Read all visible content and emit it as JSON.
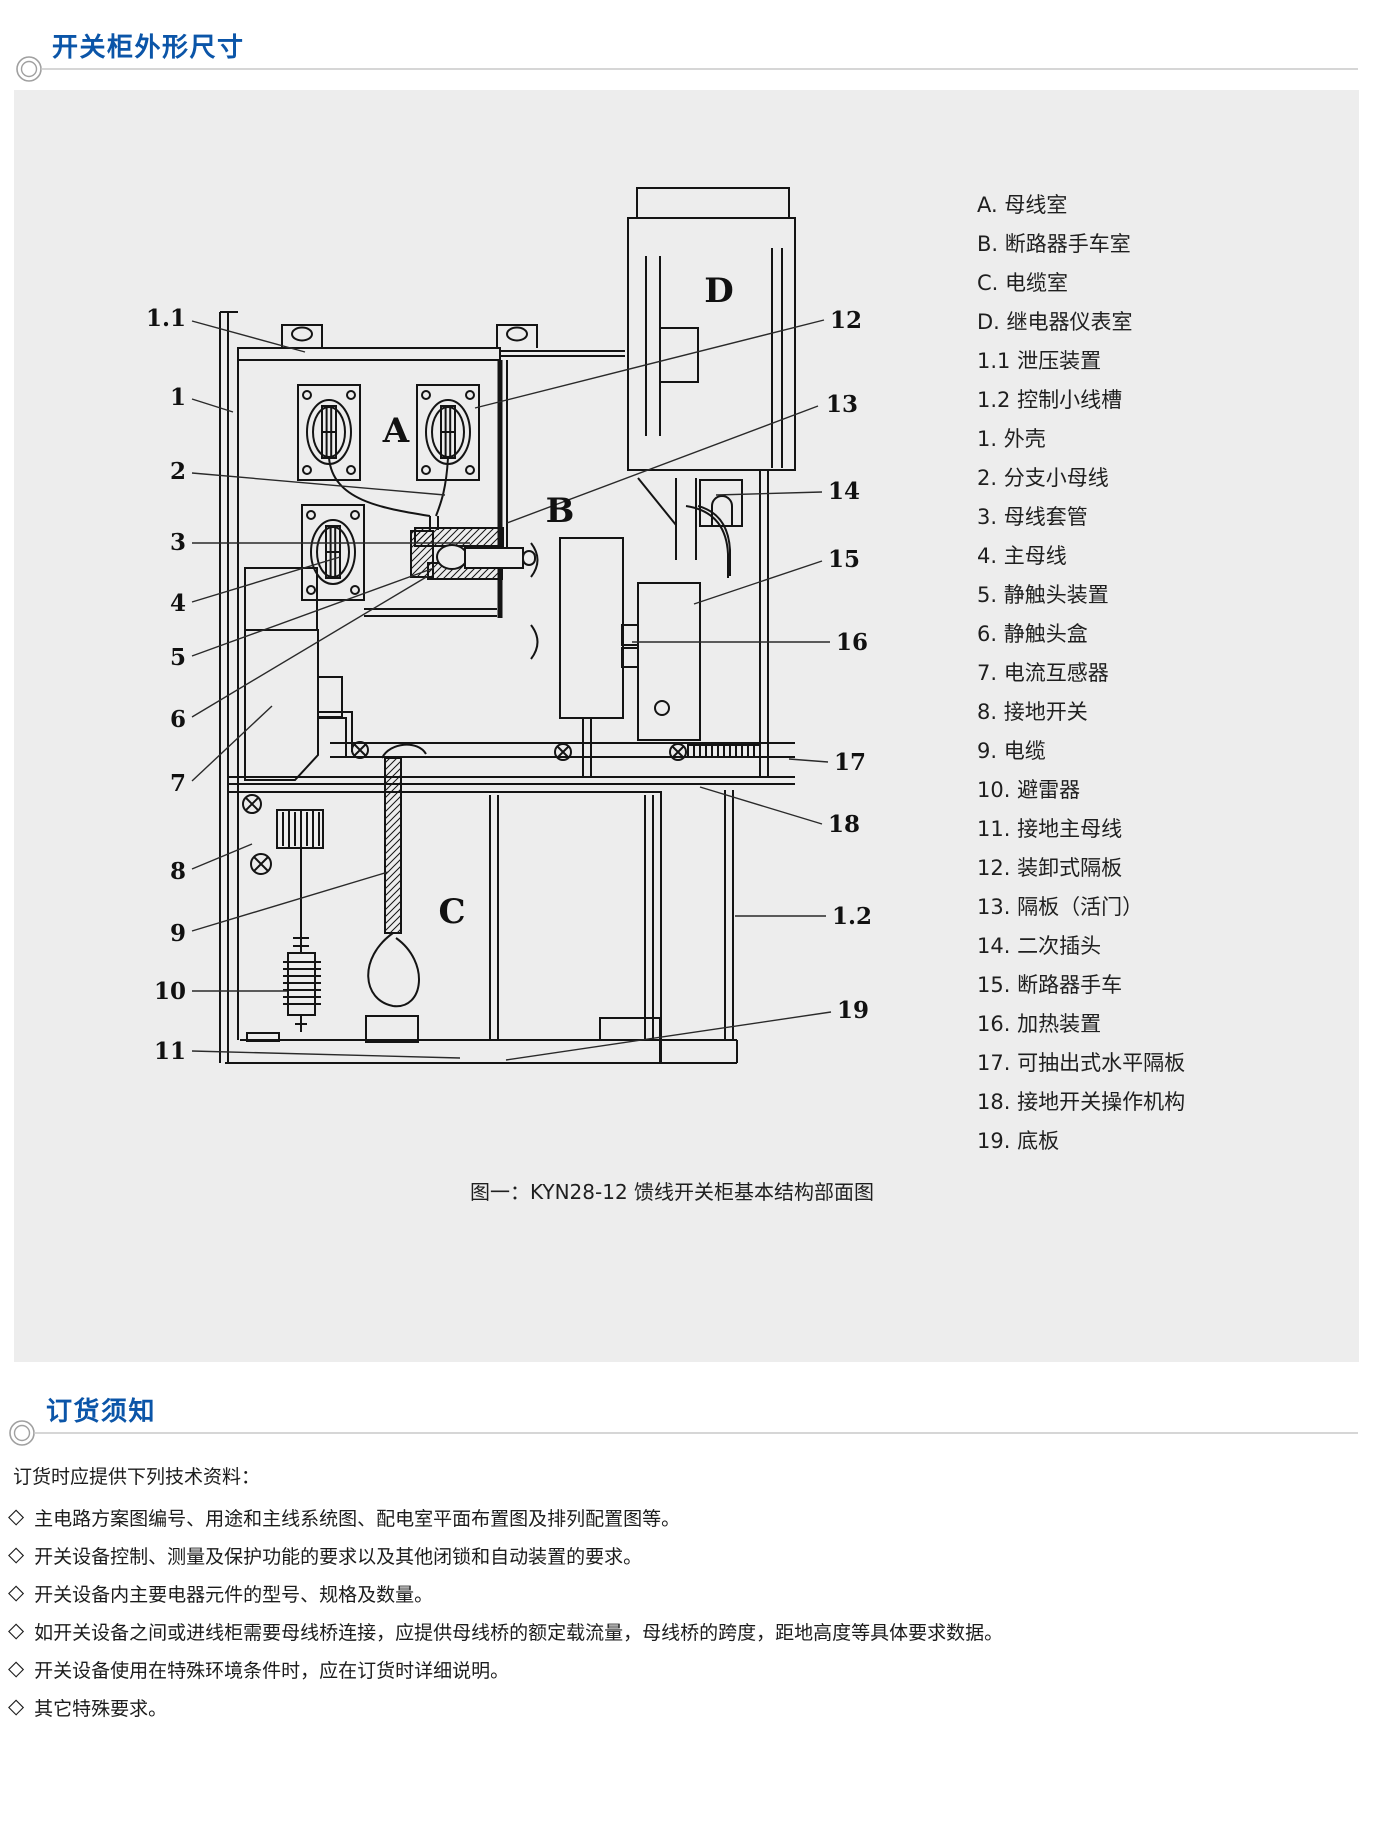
{
  "colors": {
    "accent_blue": "#0b55a8",
    "panel_bg": "#ededed",
    "text": "#1c1c1c",
    "rule_gray": "#c8c8c8",
    "diagram_stroke": "#141414"
  },
  "sections": [
    {
      "title": "开关柜外形尺寸"
    },
    {
      "title": "订货须知"
    }
  ],
  "figure": {
    "caption": "图一：KYN28-12 馈线开关柜基本结构部面图",
    "compartment_labels": [
      "A",
      "B",
      "C",
      "D"
    ],
    "left_callouts": [
      "1.1",
      "1",
      "2",
      "3",
      "4",
      "5",
      "6",
      "7",
      "8",
      "9",
      "10",
      "11"
    ],
    "right_callouts": [
      "12",
      "13",
      "14",
      "15",
      "16",
      "17",
      "18",
      "1.2",
      "19"
    ],
    "legend": [
      "A. 母线室",
      "B. 断路器手车室",
      "C. 电缆室",
      "D. 继电器仪表室",
      "1.1 泄压装置",
      "1.2 控制小线槽",
      "1. 外壳",
      "2. 分支小母线",
      "3. 母线套管",
      "4. 主母线",
      "5. 静触头装置",
      "6. 静触头盒",
      "7. 电流互感器",
      "8. 接地开关",
      "9. 电缆",
      "10. 避雷器",
      "11. 接地主母线",
      "12. 装卸式隔板",
      "13. 隔板（活门）",
      "14. 二次插头",
      "15. 断路器手车",
      "16. 加热装置",
      "17. 可抽出式水平隔板",
      "18. 接地开关操作机构",
      "19. 底板"
    ]
  },
  "ordering": {
    "intro": "订货时应提供下列技术资料：",
    "bullet": "◇",
    "items": [
      "主电路方案图编号、用途和主线系统图、配电室平面布置图及排列配置图等。",
      "开关设备控制、测量及保护功能的要求以及其他闭锁和自动装置的要求。",
      "开关设备内主要电器元件的型号、规格及数量。",
      "如开关设备之间或进线柜需要母线桥连接，应提供母线桥的额定载流量，母线桥的跨度，距地高度等具体要求数据。",
      "开关设备使用在特殊环境条件时，应在订货时详细说明。",
      "其它特殊要求。"
    ]
  }
}
